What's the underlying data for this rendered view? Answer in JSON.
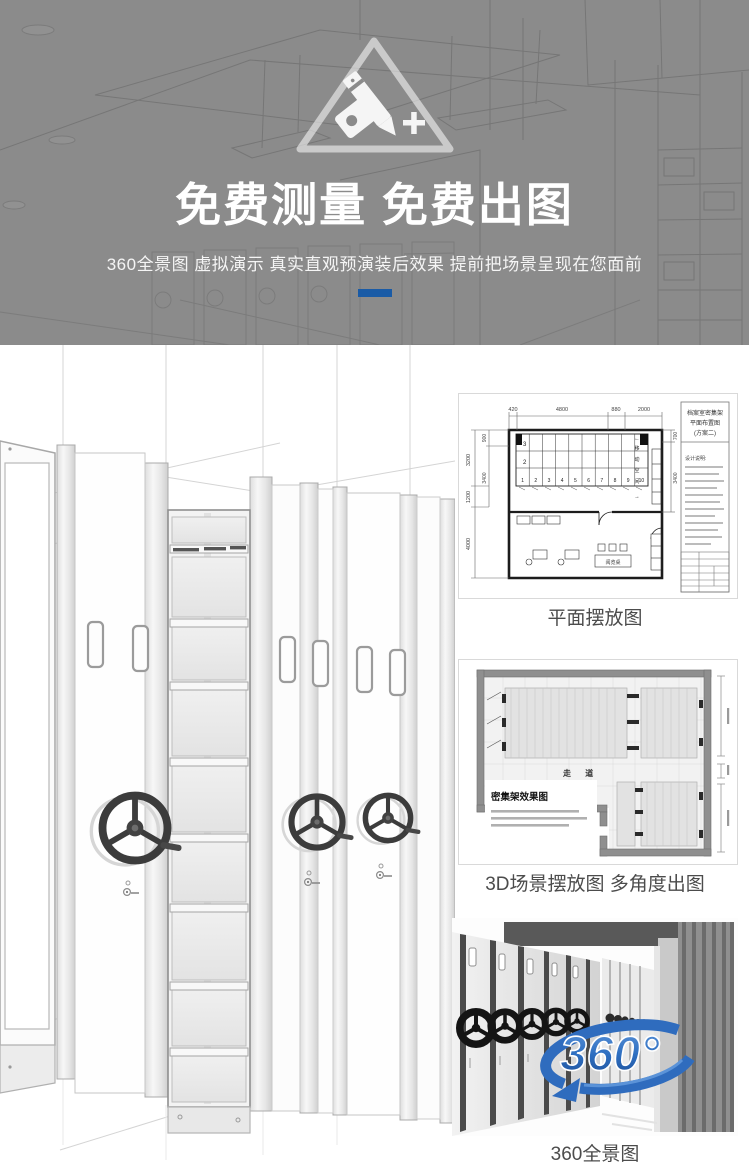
{
  "banner": {
    "badge_icon": "measure-drawing-badge-icon",
    "heading": "免费测量 免费出图",
    "subheading": "360全景图 虚拟演示 真实直观预演装后效果 提前把场景呈现在您面前",
    "accent_color": "#1a5ba6",
    "background_color": "#8b8b8b"
  },
  "figures": {
    "plan": {
      "caption": "平面摆放图",
      "title_block": [
        "档案室密集架",
        "平面布置图",
        "(方案二)"
      ],
      "notes_heading": "设计说明:",
      "dims_top": [
        "420",
        "4800",
        "880",
        "2000"
      ],
      "dims_left": [
        "900",
        "3200",
        "3400",
        "1200",
        "4000"
      ],
      "dims_right": [
        "700",
        "3400"
      ],
      "bays": [
        "1",
        "2",
        "3",
        "4",
        "5",
        "6",
        "7",
        "8",
        "9",
        "10"
      ],
      "row_labels": [
        "3",
        "2"
      ],
      "moving_label": [
        "移",
        "动",
        "空",
        "间"
      ],
      "arrows": [
        "←",
        "→"
      ],
      "desk_label": "阅览桌"
    },
    "scene3d": {
      "caption": "3D场景摆放图 多角度出图",
      "drawing_title": "密集架效果图",
      "aisle_label": "走  道"
    },
    "pano": {
      "caption": "360全景图",
      "logo_text": "360°",
      "logo_color": "#2e6fc1"
    }
  }
}
